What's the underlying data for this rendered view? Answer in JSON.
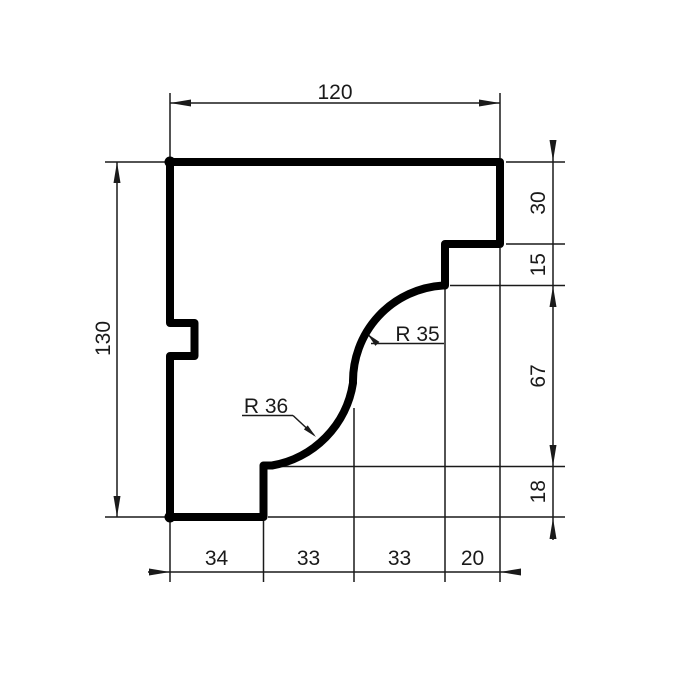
{
  "drawing": {
    "dimensions": {
      "top_width": "120",
      "left_height": "130",
      "right_step": "30",
      "right_fillet_drop": "15",
      "right_curve_height": "67",
      "right_base": "18",
      "bottom_seg1": "34",
      "bottom_seg2": "33",
      "bottom_seg3": "33",
      "bottom_seg4": "20",
      "radius_upper": "R 35",
      "radius_lower": "R 36"
    },
    "colors": {
      "outline": "#000000",
      "dimension_lines": "#1a1a1a",
      "background": "#ffffff"
    }
  }
}
